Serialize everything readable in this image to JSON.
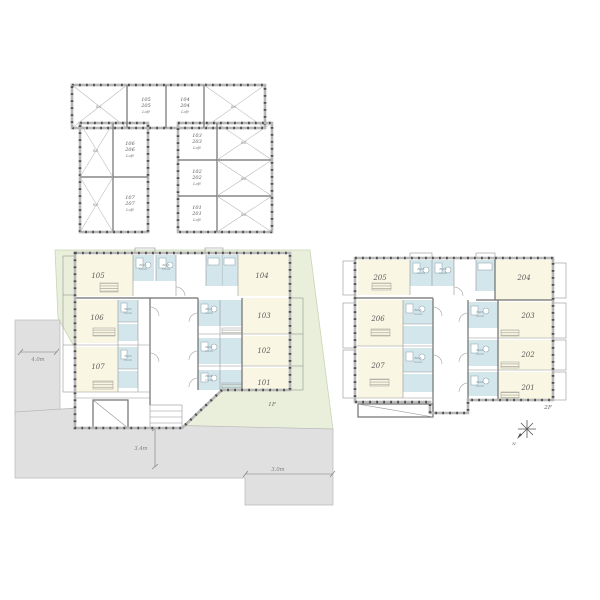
{
  "colors": {
    "room_fill": "#f9f6e3",
    "wet_fill": "#d3e6ec",
    "site_fill": "#e9efda",
    "site_edge": "#c9d5b5",
    "road_fill": "#e0e0e0",
    "road_edge": "#b9b9b9"
  },
  "loft_plan": {
    "balcony_label": "Bal.",
    "rooms": [
      {
        "line1": "105",
        "line2": "205",
        "type": "Loft"
      },
      {
        "line1": "104",
        "line2": "204",
        "type": "Loft"
      },
      {
        "line1": "106",
        "line2": "206",
        "type": "Loft"
      },
      {
        "line1": "107",
        "line2": "207",
        "type": "Loft"
      },
      {
        "line1": "103",
        "line2": "203",
        "type": "Loft"
      },
      {
        "line1": "102",
        "line2": "202",
        "type": "Loft"
      },
      {
        "line1": "101",
        "line2": "201",
        "type": "Loft"
      }
    ]
  },
  "floor1": {
    "label": "1F",
    "rooms": {
      "r105": "105",
      "r104": "104",
      "r106": "106",
      "r107": "107",
      "r103": "103",
      "r102": "102",
      "r101": "101"
    },
    "bath": {
      "line1": "Bath",
      "line2": "room"
    },
    "dimensions": {
      "left": "4.0m",
      "bottom": "3.4m",
      "right": "3.0m"
    }
  },
  "floor2": {
    "label": "2F",
    "rooms": {
      "r205": "205",
      "r204": "204",
      "r206": "206",
      "r207": "207",
      "r203": "203",
      "r202": "202",
      "r201": "201"
    },
    "bath": {
      "line1": "Bath",
      "line2": "room"
    },
    "compass": "N"
  }
}
